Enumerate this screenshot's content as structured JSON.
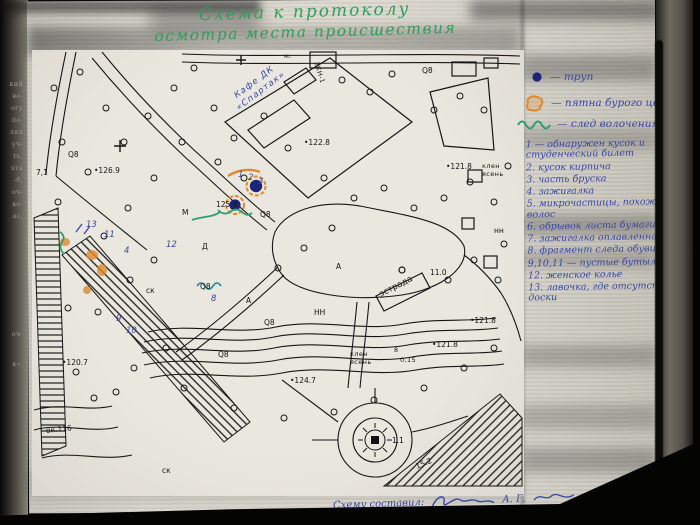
{
  "page": {
    "title_line1": "Схема к протоколу",
    "title_line2": "осмотра места происшествия",
    "footer_label": "Схему составил:",
    "footer_initials": "А. Г."
  },
  "legend": {
    "symbols": [
      "— труп",
      "— пятна бурого цвета",
      "— след волочения"
    ],
    "items": [
      "1 — обнаружен кусок и студенческий билет",
      "2. кусок кирпича",
      "3. часть бруска",
      "4. зажигалка",
      "5. микрочастицы, похожие на волос",
      "6. обрывок листа бумаги",
      "7. зажигалка оплавленная",
      "8. фрагмент следа обуви",
      "9,10,11 — пустые бутылки",
      "12. женское колье",
      "13. лавочка, где отсутствуют доски"
    ]
  },
  "map": {
    "annotation_cafe_line1": "Кафе ДК",
    "annotation_cafe_line2": "«Спартак»",
    "labels": [
      "2КН-1",
      "м.",
      "•122.8",
      "•126.9",
      "125.9",
      "•121.8",
      "•121.8",
      "•121.8",
      "•124.7",
      "•120.7",
      "15.2",
      "1.1",
      "11.0",
      "эстрада",
      "клен",
      "ясень",
      "клен",
      "ясень",
      "8",
      "0,15",
      "Q8",
      "Q8",
      "Q8",
      "Q8",
      "Q8",
      "Q8",
      "НН",
      "нн",
      "ск",
      "ск",
      "ок.116",
      "7,1",
      "М",
      "А",
      "Д",
      "А"
    ],
    "item_marks": [
      "1",
      "2",
      "3",
      "13",
      "11",
      "4",
      "12",
      "8",
      "9",
      "10"
    ]
  },
  "margin": {
    "fragments": [
      "кий",
      "ве-",
      "огу",
      "пе-",
      "ляя",
      "уч-",
      "ть,",
      "этя",
      "-б,",
      "оч-",
      "ве-",
      "ас,",
      "оч-",
      "в»."
    ]
  },
  "colors": {
    "ink_green": "#2f9e5a",
    "ink_blue": "#3a47a3",
    "ink_orange": "#e08a2f",
    "ink_teal": "#2f8fa0",
    "corpse_dot": "#1b2478",
    "paper": "#d8d5cc",
    "linework": "#161616"
  }
}
